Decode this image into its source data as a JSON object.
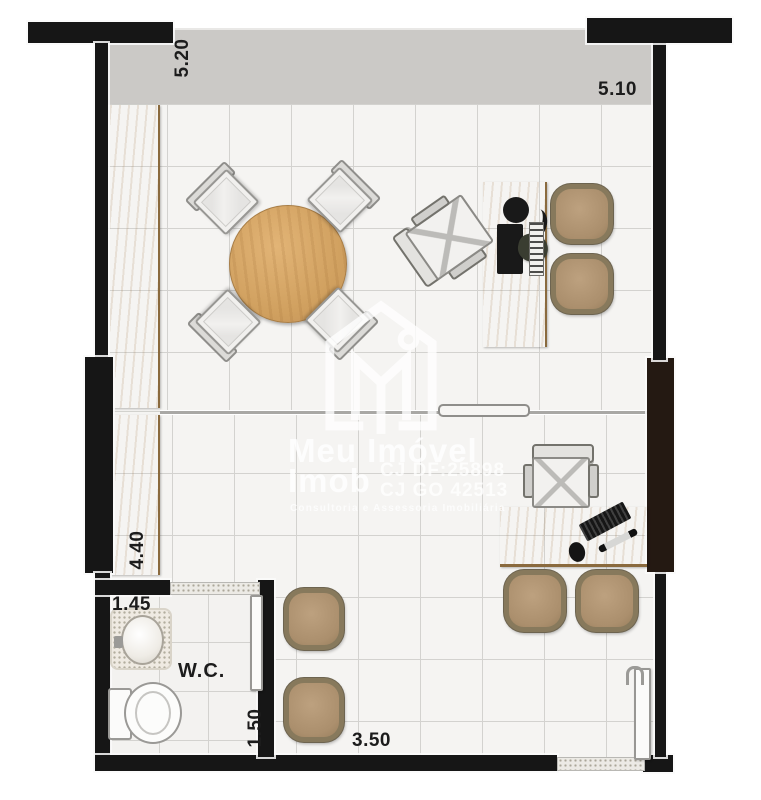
{
  "plan": {
    "type": "floor-plan",
    "labels": {
      "dim_top_left": "5.20",
      "dim_top_right": "5.10",
      "dim_left": "4.40",
      "dim_wc_width": "1.45",
      "dim_wc_depth": "1.50",
      "dim_bottom": "3.50",
      "wc_room": "W.C."
    },
    "watermark": {
      "logo": "house-m-logo",
      "brand_line1": "Meu Imóvel",
      "brand_line2": "Imob",
      "reg_line1": "CJ DF:25898",
      "reg_line2": "CJ GO 42513",
      "tagline": "Consultoria e Assessoria Imobiliária"
    },
    "colors": {
      "wall": "#161616",
      "wall_pillar_dark": "#241912",
      "wood": "#d2a160",
      "floor_tile": "#f5f4f2",
      "tile_grout": "#d3d2cf",
      "balcony_gray": "#cbc9c6",
      "guest_chair_tan": "#ab8f6d",
      "watermark_white": "#ffffff"
    },
    "furniture": [
      "round-meeting-table",
      "conference-chair x4",
      "desk-upper-room",
      "desk-lower-room",
      "office-swivel-chair x2",
      "tan-guest-chair x6",
      "wall-counter x2",
      "wc-sink",
      "wc-toilet",
      "entry-door",
      "wc-door",
      "sliding-glass-partition"
    ]
  }
}
